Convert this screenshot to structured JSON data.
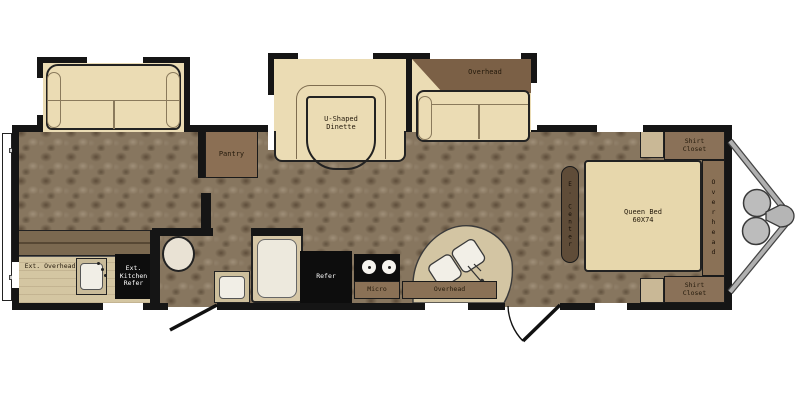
{
  "title": "Travel trailer floor plan",
  "colors": {
    "wall": "#151515",
    "floor_base": "#87765f",
    "sofa_cream": "#ebdcb4",
    "counter_tan": "#d4c6a2",
    "cabinet_brown": "#8a7156",
    "overhead_dark_brown": "#7b6046",
    "appliance_black": "#0d0d0d",
    "bed_tan": "#e7d7ac",
    "metal_gray": "#bcbcbc"
  },
  "labels": {
    "pantry": "Pantry",
    "dinette": "U-Shaped\nDinette",
    "sofa_overhead": "Overhead",
    "kitchen_refer": "Refer",
    "kitchen_micro": "Micro",
    "kitchen_overhead": "Overhead",
    "ext_overhead": "Ext. Overhead",
    "ext_kitchen_refer": "Ext.\nKitchen\nRefer",
    "queen_bed": "Queen Bed\n60X74",
    "shirt_closet_top": "Shirt\nCloset",
    "shirt_closet_bottom": "Shirt\nCloset",
    "bedroom_overhead": "Overhead",
    "entertainment_center": "E. Center"
  }
}
